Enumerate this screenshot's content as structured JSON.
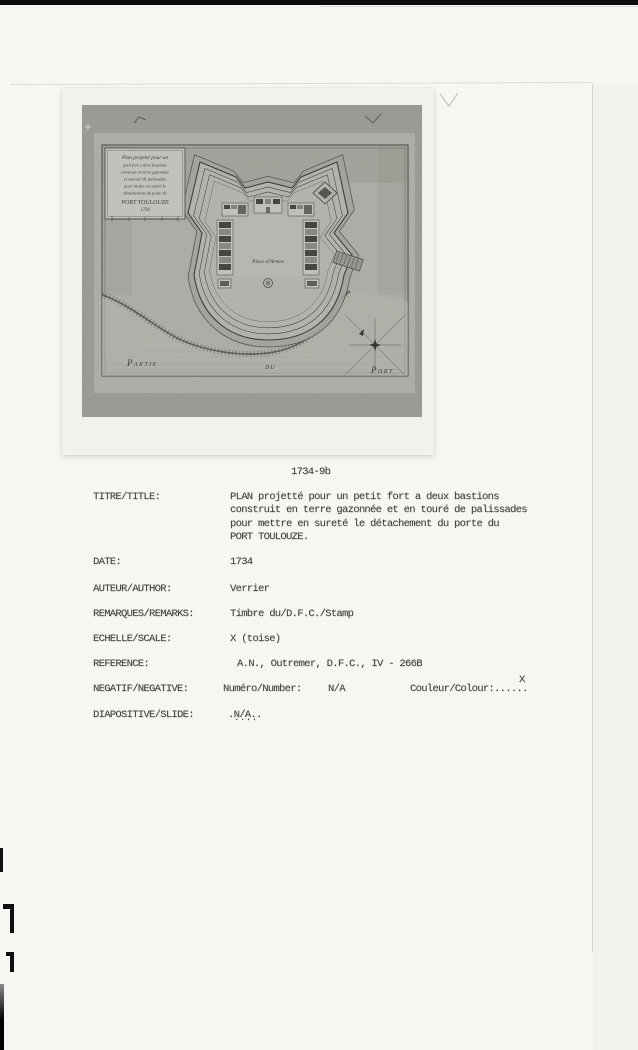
{
  "colors": {
    "film_black": "#0c0c0c",
    "paper": "#f6f6f3",
    "print_paper": "#f2f1ed",
    "photo_gray": "#9c9a96",
    "map_sheet": "#b0aea8",
    "map_ink": "#3e3c37",
    "typewriter_ink": "#403f3a"
  },
  "photo": {
    "map": {
      "cartouche_lines": [
        "Plan projetté pour un",
        "petit fort a deux bastions",
        "construit en terre gazonnée",
        "et entouré de palissades",
        "pour mettre en sureté le",
        "détachement du poste de",
        "PORT TOULOUZE",
        "1734"
      ],
      "place_of_arms": "Place d'Armes",
      "water_labels": [
        "Partie",
        "du",
        "Port"
      ]
    }
  },
  "catalog": {
    "photo_number": "1734-9b",
    "title": {
      "label": "TITRE/TITLE:",
      "lines": [
        "PLAN projetté pour un petit fort a deux bastions",
        "construit en terre gazonnée et en touré de palissades",
        "pour mettre en sureté le détachement du porte du",
        "PORT TOULOUZE."
      ]
    },
    "date": {
      "label": "DATE:",
      "value": "1734"
    },
    "author": {
      "label": "AUTEUR/AUTHOR:",
      "value": "Verrier"
    },
    "remarks": {
      "label": "REMARQUES/REMARKS:",
      "value": "Timbre du/D.F.C./Stamp"
    },
    "scale": {
      "label": "ECHELLE/SCALE:",
      "value": "X (toise)"
    },
    "reference": {
      "label": "REFERENCE:",
      "value": "A.N., Outremer, D.F.C., IV - 266B"
    },
    "negative": {
      "label": "NEGATIF/NEGATIVE:",
      "number_label": "Numéro/Number:",
      "number_value": "N/A",
      "colour_label": "Couleur/Colour:",
      "colour_dots": "......",
      "colour_mark": "X"
    },
    "slide": {
      "label": "DIAPOSITIVE/SLIDE:",
      "value": ".N/A..",
      "under_dots": "...."
    }
  }
}
